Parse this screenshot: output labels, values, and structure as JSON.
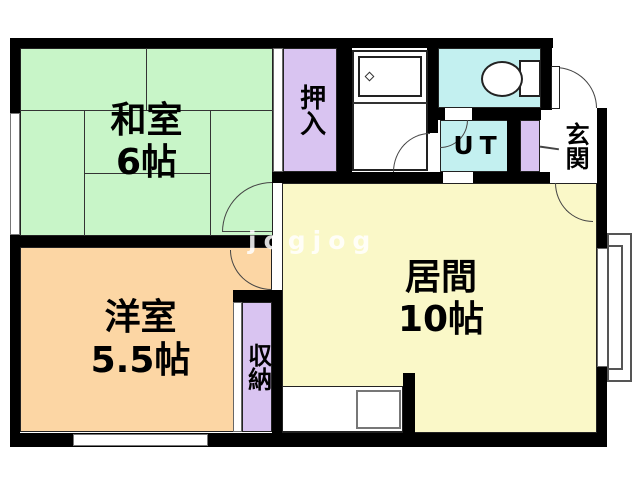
{
  "floor_plan": {
    "watermark": "jogjog",
    "rooms": {
      "washitsu": {
        "name": "和室",
        "size": "6帖"
      },
      "youshitsu": {
        "name": "洋室",
        "size": "5.5帖"
      },
      "ima": {
        "name": "居間",
        "size": "10帖"
      },
      "oshiire": {
        "label": "押入"
      },
      "shuunou": {
        "label": "収納"
      },
      "genkan": {
        "label": "玄関"
      },
      "utility": {
        "label": "UT"
      }
    },
    "colors": {
      "tatami_green": "#c8f5c8",
      "closet_purple": "#d9c4f1",
      "water_cyan": "#c3f0f0",
      "living_yellow": "#faf8c8",
      "bedroom_orange": "#fcd6a4",
      "wall_black": "#000000"
    }
  }
}
